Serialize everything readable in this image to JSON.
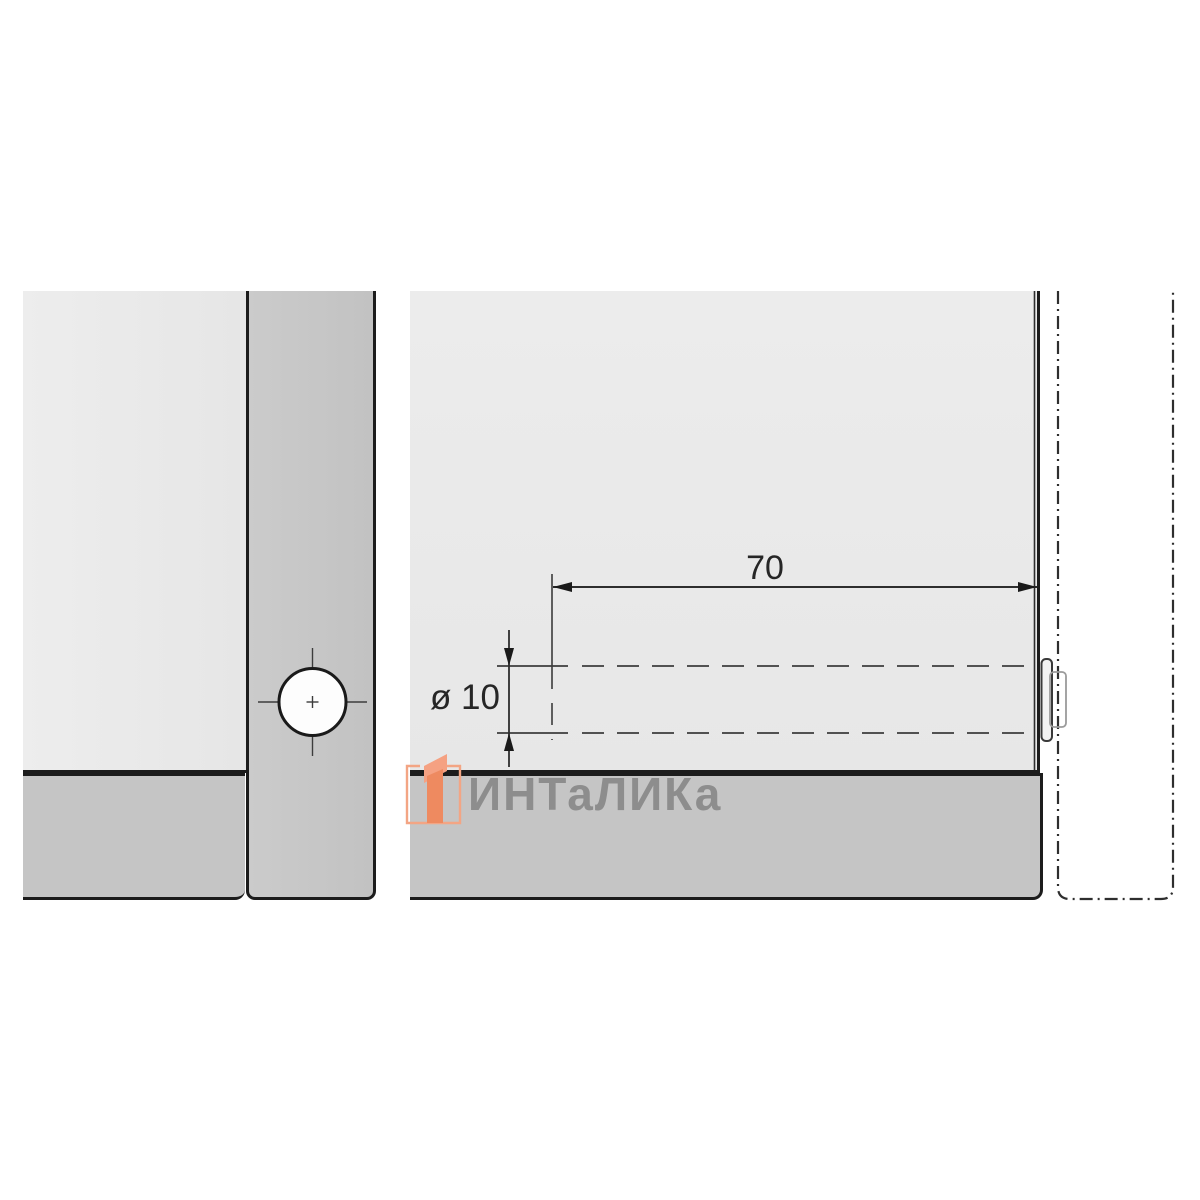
{
  "diagram": {
    "kind": "furniture-dowel-drilling-technical-drawing",
    "labels": {
      "depth_dimension": "70",
      "diameter_dimension": "ø 10"
    },
    "watermark": {
      "text": "ИНТаЛИКа"
    },
    "colors": {
      "panel_light": "#e9e9e9",
      "panel_dark_strip": "#c5c5c5",
      "outline_black": "#1c1c1c",
      "dimension_line": "#2e2e2e",
      "hole_fill": "#fdfdfd",
      "logo_outline_orange": "#f3a584",
      "logo_flag_orange": "#f5a182",
      "logo_bar_orange": "#ee8a60",
      "watermark_gray": "#8b8b8b"
    }
  }
}
